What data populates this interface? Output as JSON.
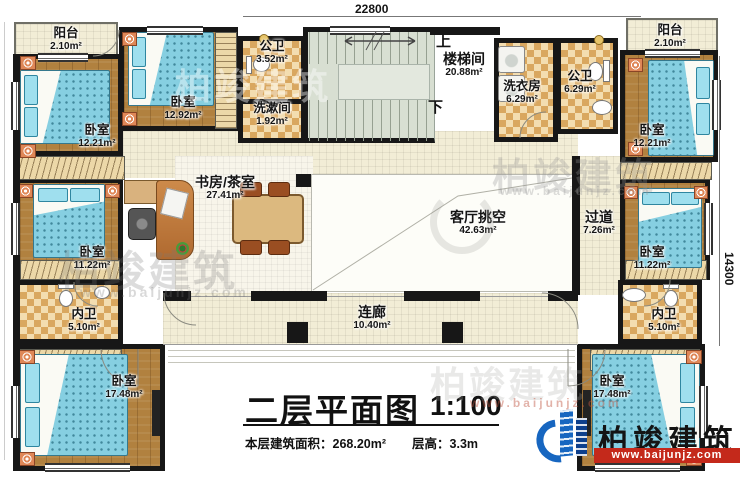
{
  "plan": {
    "dim_top": "22800",
    "dim_right": "14300",
    "stair_up": "上",
    "stair_down": "下"
  },
  "rooms": [
    {
      "name": "阳台",
      "area": "2.10m²"
    },
    {
      "name": "卧室",
      "area": "12.21m²"
    },
    {
      "name": "卧室",
      "area": "12.92m²"
    },
    {
      "name": "公卫",
      "area": "3.52m²"
    },
    {
      "name": "洗漱间",
      "area": "1.92m²"
    },
    {
      "name": "楼梯间",
      "area": "20.88m²"
    },
    {
      "name": "洗衣房",
      "area": "6.29m²"
    },
    {
      "name": "公卫",
      "area": "6.29m²"
    },
    {
      "name": "阳台",
      "area": "2.10m²"
    },
    {
      "name": "卧室",
      "area": "12.21m²"
    },
    {
      "name": "书房/茶室",
      "area": "27.41m²"
    },
    {
      "name": "客厅挑空",
      "area": "42.63m²"
    },
    {
      "name": "过道",
      "area": "7.26m²"
    },
    {
      "name": "卧室",
      "area": "11.22m²"
    },
    {
      "name": "卧室",
      "area": "11.22m²"
    },
    {
      "name": "内卫",
      "area": "5.10m²"
    },
    {
      "name": "内卫",
      "area": "5.10m²"
    },
    {
      "name": "卧室",
      "area": "17.48m²"
    },
    {
      "name": "卧室",
      "area": "17.48m²"
    },
    {
      "name": "连廊",
      "area": "10.40m²"
    }
  ],
  "title": {
    "main": "二层平面图",
    "scale": "1:100",
    "area_label": "本层建筑面积：",
    "area_value": "268.20m²",
    "height_label": "层高：",
    "height_value": "3.3m"
  },
  "brand": {
    "name": "柏竣建筑",
    "url": "www.baijunjz.com"
  },
  "watermark": {
    "name": "柏竣建筑",
    "url": "www.baijunjz.com"
  },
  "colors": {
    "wall": "#171717",
    "wood_floor": "#b1813f",
    "bed_blue": "#86cfe1",
    "tile_tan": "#d9a75f",
    "floor_cream": "#f2edd6",
    "stair_gray": "#d8dfd2",
    "brand_blue": "#1766c0",
    "brand_red": "#c4291b"
  }
}
